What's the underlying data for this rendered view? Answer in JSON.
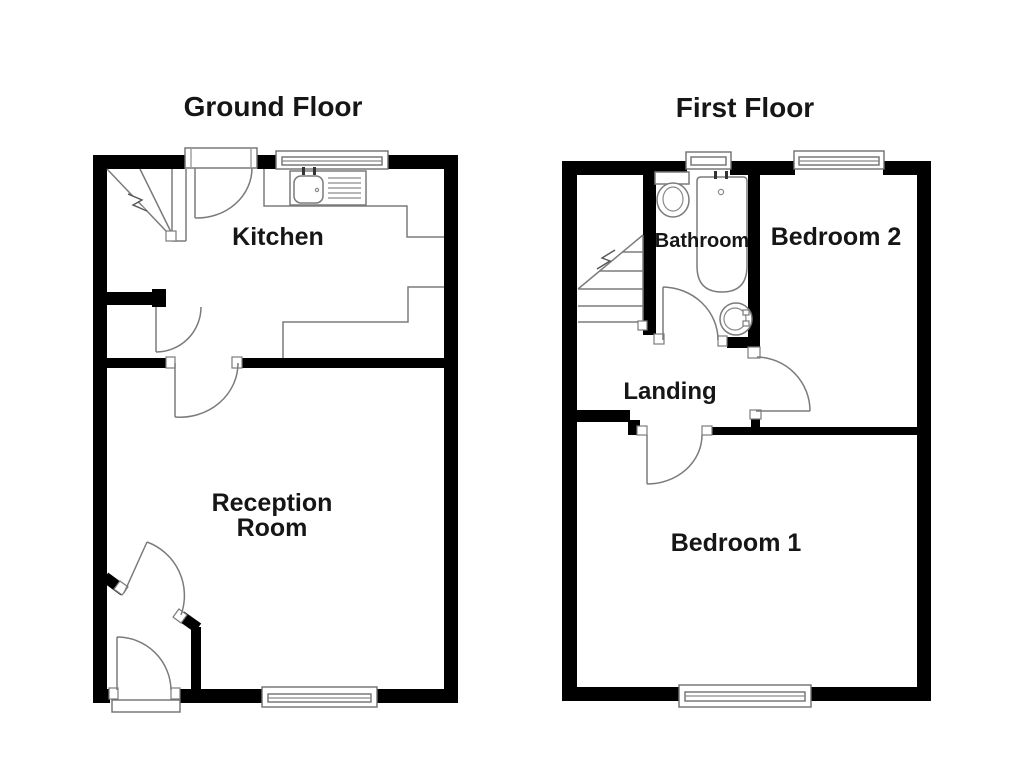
{
  "figure": "floor-plan",
  "plans": {
    "ground": {
      "title": "Ground Floor",
      "rooms": {
        "kitchen": "Kitchen",
        "reception_line1": "Reception",
        "reception_line2": "Room"
      },
      "fixtures": [
        "staircase",
        "sink-drainer-unit",
        "kitchen-counter",
        "back-door",
        "front-door",
        "lobby-door",
        "inner-doors",
        "windows"
      ]
    },
    "first": {
      "title": "First Floor",
      "rooms": {
        "bathroom": "Bathroom",
        "bedroom2": "Bedroom 2",
        "landing": "Landing",
        "bedroom1": "Bedroom 1"
      },
      "fixtures": [
        "staircase",
        "toilet",
        "bath-tub",
        "wash-basin",
        "doors",
        "windows"
      ]
    }
  },
  "colors": {
    "wall": "#000000",
    "linework": "#7b7b7b",
    "text": "#161616",
    "background": "#ffffff"
  }
}
